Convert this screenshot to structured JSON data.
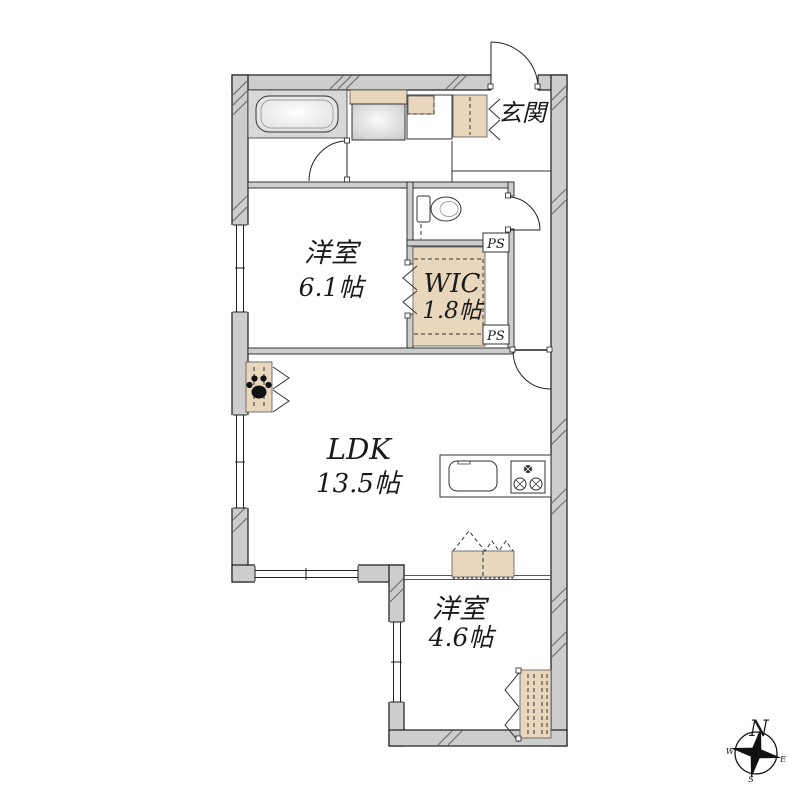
{
  "plan": {
    "rooms": {
      "bedroom1": {
        "name": "洋室",
        "size": "6.1帖"
      },
      "wic": {
        "name": "WIC",
        "size": "1.8帖"
      },
      "ldk": {
        "name": "LDK",
        "size": "13.5帖"
      },
      "bedroom2": {
        "name": "洋室",
        "size": "4.6帖"
      },
      "entrance": {
        "name": "玄関"
      }
    },
    "labels": {
      "ps_top": "PS",
      "ps_bottom": "PS"
    },
    "compass": {
      "north": "N",
      "west": "W",
      "east": "E",
      "south": "S"
    },
    "colors": {
      "wall": "#cdcdcd",
      "storage": "#e9d7bd",
      "bath_floor": "#d8d8d8",
      "line": "#1a1a1a"
    }
  }
}
